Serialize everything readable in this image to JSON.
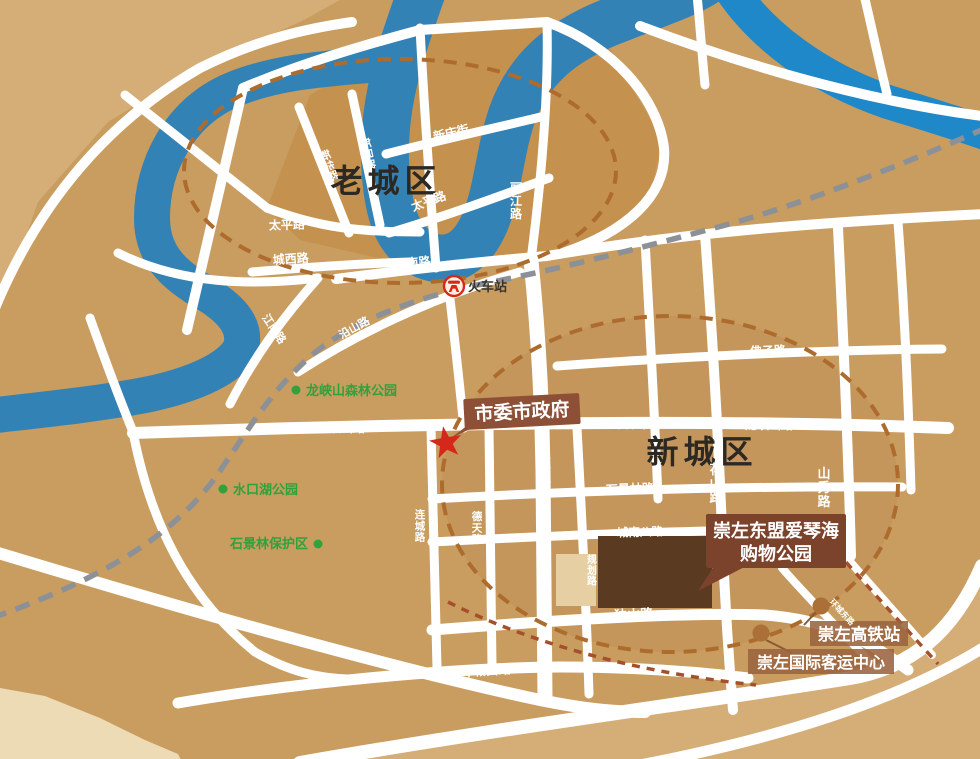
{
  "map": {
    "districts": {
      "old": "老城区",
      "new": "新城区"
    },
    "roads": {
      "xinhua": "新华路",
      "xinmin": "新民路",
      "xinqing": "新庆街",
      "taiping": "太平路",
      "lijiang": "丽江路",
      "chengxi": "城西路",
      "jiangnan": "江南路",
      "yanshan": "沿山路",
      "longxiashan": "龙峡山路",
      "fozi": "佛子路",
      "youyi": "友谊大道",
      "shijinglin": "石景林路",
      "huashan": "花山路",
      "shanxiu": "山秀路",
      "liancheng": "连城路",
      "detian": "德天路",
      "chengnanba": "城南八路",
      "guihua": "规划路",
      "dushan": "独山路",
      "huanchengxi": "环城西路",
      "huanchengdong": "环城东路"
    },
    "pois": {
      "train_station": "火车站",
      "city_government": "市委市政府",
      "forest_park": "龙峡山森林公园",
      "shuikou_lake_park": "水口湖公园",
      "shijinglin_reserve": "石景林保护区",
      "shopping_park_line1": "崇左东盟爱琴海",
      "shopping_park_line2": "购物公园",
      "hsr_station": "崇左高铁站",
      "passenger_center": "崇左国际客运中心"
    },
    "colors": {
      "land": "#c99c5f",
      "land_light": "#d5ad76",
      "old_blocks": "#c28d4a",
      "cream": "#ecdbb4",
      "cream_block": "#e6cfa3",
      "river": "#3382b5",
      "river_bright": "#1f88c8",
      "road": "#ffffff",
      "railway": "#8c9097",
      "ring_dash": "#ad6c2d",
      "hsr_dash": "#a5502b",
      "accent_red": "#d6281a",
      "label_bg": "#8d5037",
      "label_bg_dark": "#7b422c",
      "station_label_bg": "#9a6340",
      "dark_block": "#5a3a20",
      "green": "#2fa23c",
      "brown_text": "#a3552a",
      "dot_brown": "#aa7038",
      "district_text": "#2c2822"
    }
  }
}
